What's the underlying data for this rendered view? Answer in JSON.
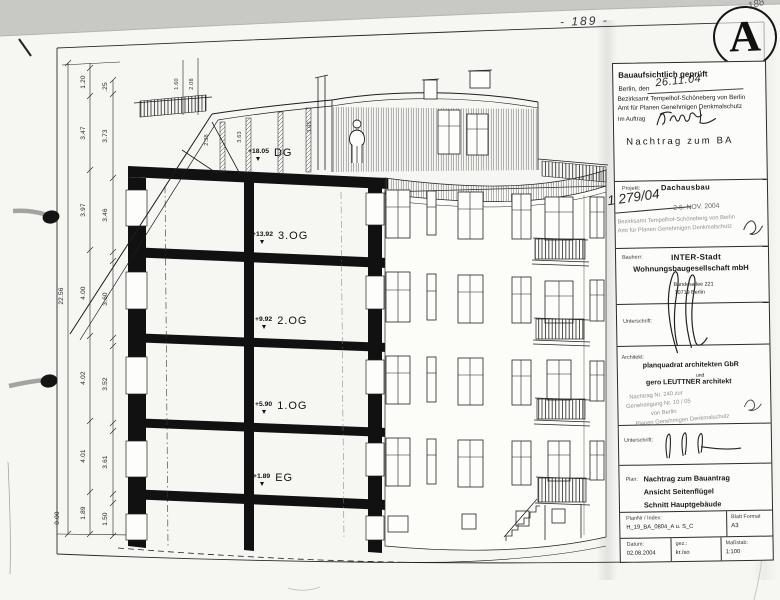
{
  "page": {
    "corner_number": "188",
    "page_number": "- 189 -",
    "revision_letter": "A"
  },
  "stamp": {
    "title": "Bauaufsichtlich geprüft",
    "place_label": "Berlin, den",
    "date": "26.11.04",
    "authority1": "Bezirksamt Tempelhof-Schöneberg von Berlin",
    "authority2": "Amt für Planen Genehmigen Denkmalschutz",
    "order_label": "Im Auftrag",
    "note": "Nachtrag zum BA"
  },
  "project": {
    "label": "Projekt:",
    "name": "Dachausbau",
    "file_number": "1 279/04",
    "stamp_date": "2 6. NOV. 2004",
    "stamp_line1": "Bezirksamt Tempelhof-Schöneberg von Berlin",
    "stamp_line2": "Amt für Planen Genehmigen Denkmalschutz"
  },
  "client": {
    "label": "Bauherr:",
    "name1": "INTER-Stadt",
    "name2": "Wohnungsbaugesellschaft mbH",
    "street": "Bundesallee 221",
    "city": "10719 Berlin"
  },
  "signature1": {
    "label": "Unterschrift:"
  },
  "architect": {
    "label": "Architekt:",
    "firm": "planquadrat architekten GbR",
    "conjunction": "und",
    "partner": "gero LEUTTNER architekt",
    "stamp_fragments": [
      "Nachtrag Nr. 240 zur",
      "Genehmigung Nr. 10 / 05",
      "von Berlin",
      "Planen Genehmigen Denkmalschutz"
    ]
  },
  "signature2": {
    "label": "Unterschrift:"
  },
  "plan": {
    "label": "Plan:",
    "line1": "Nachtrag zum Bauantrag",
    "line2": "Ansicht Seitenflügel",
    "line3": "Schnitt Hauptgebäude"
  },
  "plan_number": {
    "label": "PlanNr / Index:",
    "value": "H_19_BA_0804_A u. S_C",
    "format_label": "Blatt Format",
    "format_value": "A3"
  },
  "meta": {
    "date_label": "Datum:",
    "date": "02.08.2004",
    "drawn_label": "gez.:",
    "drawn_by": "kr./so",
    "scale_label": "Maßstab:",
    "scale": "1:100"
  },
  "floors": [
    {
      "elevation": "+18.05",
      "name": "DG"
    },
    {
      "elevation": "+13.92",
      "name": "3.OG"
    },
    {
      "elevation": "+9.92",
      "name": "2.OG"
    },
    {
      "elevation": "+5.90",
      "name": "1.OG"
    },
    {
      "elevation": "+1.89",
      "name": "EG"
    }
  ],
  "dimensions": {
    "total_height": "22.56",
    "floor_heights": [
      "1.20",
      "3.47",
      "3.97",
      "4.00",
      "4.02",
      "4.01",
      "1.89"
    ],
    "clear_heights": [
      ".25",
      "3.73",
      "3.46",
      "3.60",
      "3.52",
      "3.61",
      "1.50"
    ],
    "roof_dims": [
      "1.60",
      "2.08",
      "2.38",
      "3.63",
      "3.05"
    ],
    "ground_level": "0.00"
  }
}
